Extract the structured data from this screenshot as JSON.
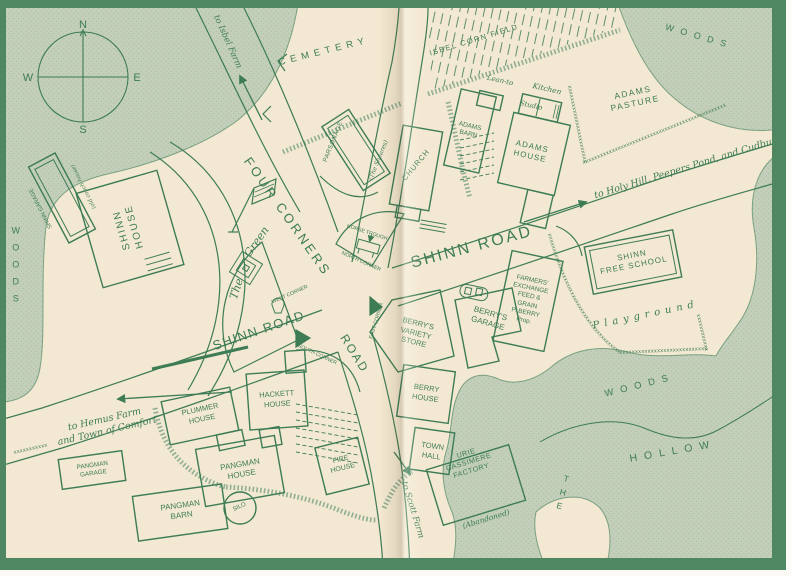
{
  "palette": {
    "ink": "#3d7c55",
    "paper": "#f3e8d1",
    "woods_fill": "#c3cfba",
    "frame": "#4e8761"
  },
  "compass": {
    "n": "N",
    "e": "E",
    "s": "S",
    "w": "W"
  },
  "labels": {
    "to_isbel_farm": "to Isbel Farm",
    "cemetery": "CEMETERY",
    "isbel_corn_field": "ISBEL CORN FIELD",
    "woods_ne": "WOODS",
    "adams_pasture": "ADAMS\nPASTURE",
    "to_holy_hill": "to Holy Hill, Peepers Pond, and Cudbury",
    "parsonage": "PARSONAGE",
    "parsonage_sub": "(The Sheares)",
    "church": "CHURCH",
    "adams_barn": "ADAMS\nBARN",
    "lean_to": "Lean-to",
    "kitchen": "Kitchen",
    "studio": "Studio",
    "adams_house": "ADAMS\nHOUSE",
    "four_corners": "FOUR CORNERS",
    "horse_trough": "HORSE TROUGH",
    "north_corner": "NORTH CORNER",
    "west_corner": "WEST CORNER",
    "east_corner": "EAST CORNER",
    "south_corner": "SOUTH CORNER",
    "green_the": "The",
    "green_green": "Green",
    "shinn_road_east": "SHINN ROAD",
    "shinn_road_west": "SHINN ROAD",
    "road_south": "ROAD",
    "shinn_house": "SHINN\nHOUSE",
    "shinn_garage": "SHINN GARAGE",
    "shinn_garage_sub": "(old coach house)",
    "woods_west": "WOODS",
    "berrys_variety_store": "BERRY'S\nVARIETY\nSTORE",
    "berrys_garage": "BERRY'S\nGARAGE",
    "farmers_exchange": "FARMERS'\nEXCHANGE\nFEED &\nGRAIN\nP. BERRY\nProp.",
    "shinn_free_school": "SHINN\nFREE SCHOOL",
    "playground": "Playground",
    "berry_house": "BERRY\nHOUSE",
    "town_hall": "TOWN\nHALL",
    "uris_factory": "URIE\nCASSIMERE\nFACTORY",
    "uris_factory_sub": "(Abandoned)",
    "to_scott_farm": "to Scott Farm",
    "woods_se": "WOODS",
    "hollow_the": "THE",
    "hollow_hollow": "HOLLOW",
    "to_hemus_farm": "to Hemus Farm\nand Town of Comfort",
    "pangman_garage": "PANGMAN\nGARAGE",
    "pangman_house": "PANGMAN\nHOUSE",
    "pangman_barn": "PANGMAN\nBARN",
    "silo": "SILO",
    "plummer_house": "PLUMMER\nHOUSE",
    "hackett_house": "HACKETT\nHOUSE",
    "fire_house": "FIRE\nHOUSE",
    "fence_char": "x"
  }
}
